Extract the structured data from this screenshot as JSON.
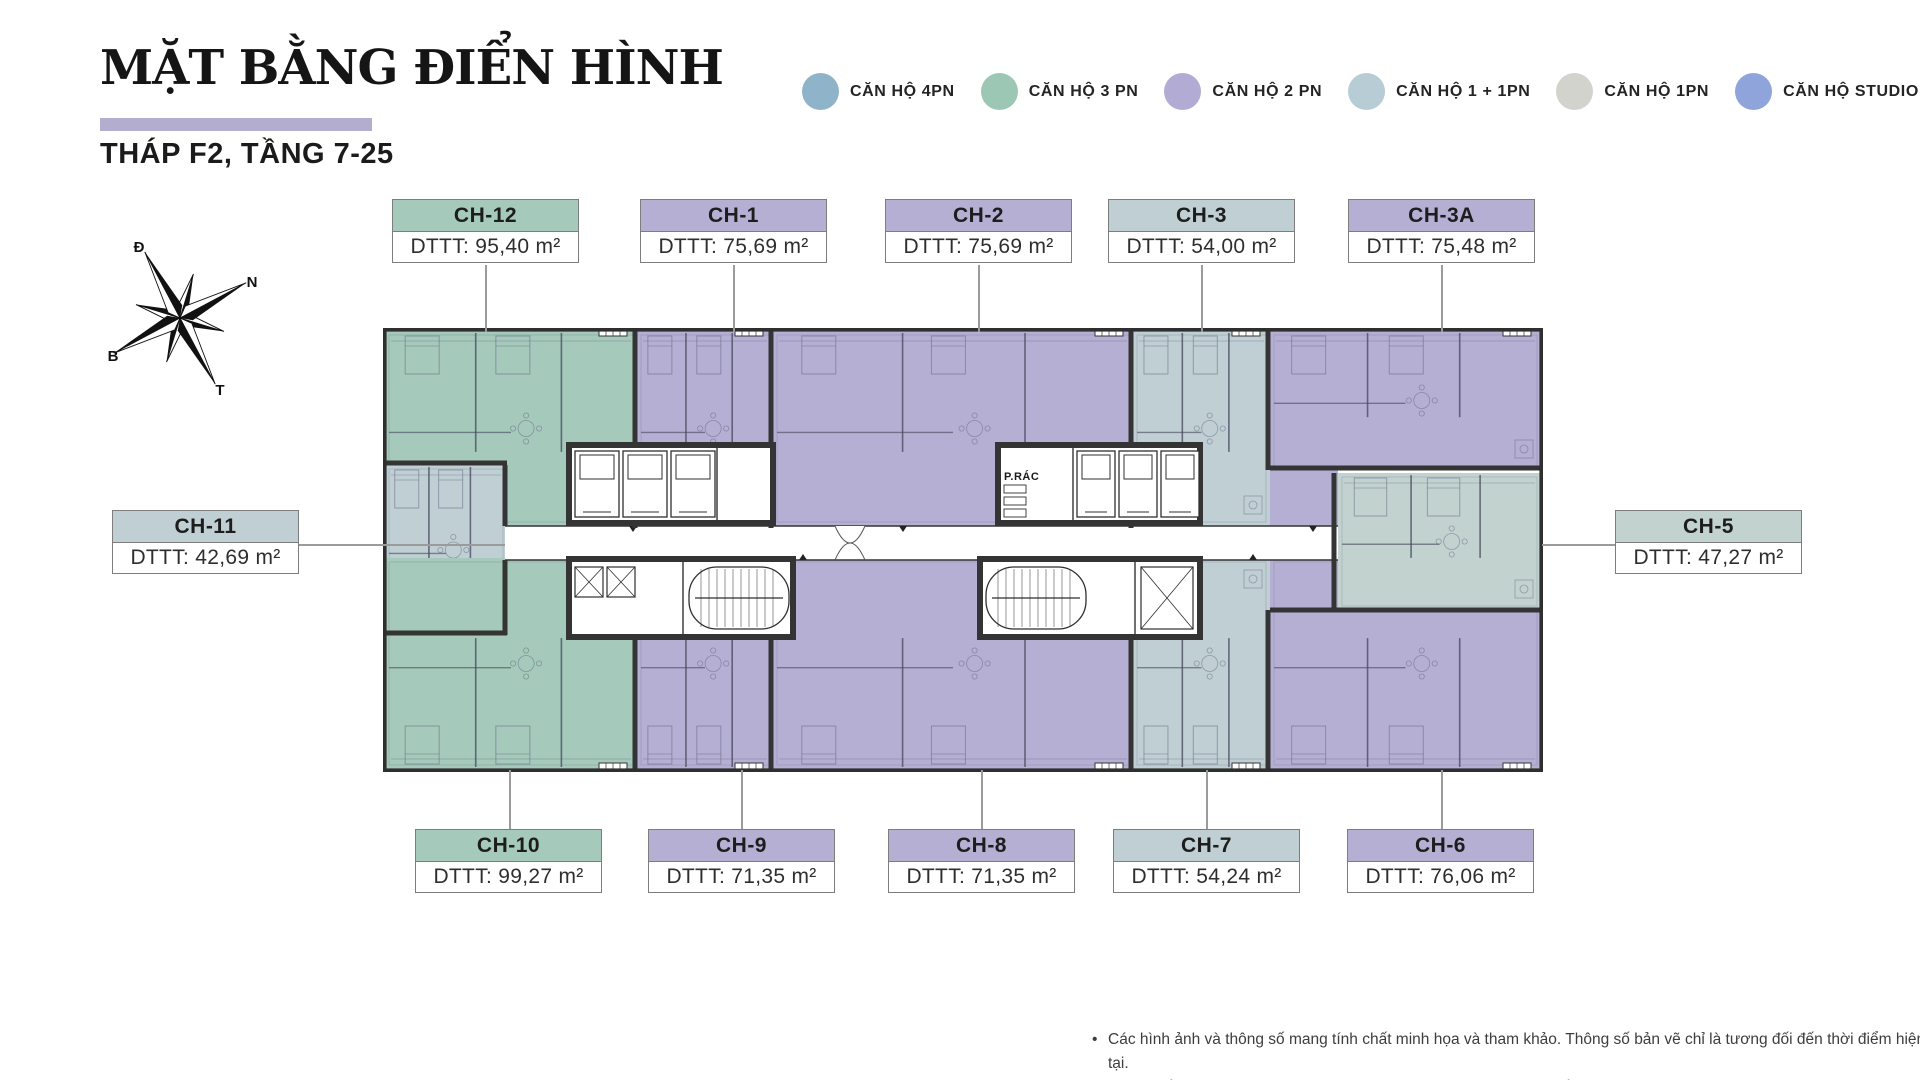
{
  "header": {
    "title": "MẶT BẰNG ĐIỂN HÌNH",
    "subtitle": "THÁP F2, TẦNG 7-25",
    "underline_color": "#b3aed0"
  },
  "legend": {
    "items": [
      {
        "label": "CĂN HỘ 4PN",
        "color": "#8fb4c9"
      },
      {
        "label": "CĂN HỘ 3 PN",
        "color": "#9cc7b4"
      },
      {
        "label": "CĂN HỘ 2 PN",
        "color": "#b2abd3"
      },
      {
        "label": "CĂN HỘ 1 + 1PN",
        "color": "#b7ccd4"
      },
      {
        "label": "CĂN HỘ 1PN",
        "color": "#d3d3cd"
      },
      {
        "label": "CĂN HỘ STUDIO",
        "color": "#8fa4da"
      }
    ]
  },
  "compass": {
    "labels": [
      {
        "text": "Đ",
        "x": 137,
        "y": 252
      },
      {
        "text": "N",
        "x": 250,
        "y": 287
      },
      {
        "text": "B",
        "x": 111,
        "y": 361
      },
      {
        "text": "T",
        "x": 218,
        "y": 395
      }
    ],
    "cx": 178,
    "cy": 318,
    "rotation": -28
  },
  "plan": {
    "x": 383,
    "y": 328,
    "w": 1160,
    "h": 444,
    "wall_color": "#343434",
    "line_color": "#60607d",
    "corridor": [
      122,
      198,
      833,
      34
    ],
    "trash_room_label": "P.RÁC",
    "type_colors": {
      "p3": "#a5c9ba",
      "p2": "#b5afd3",
      "p11": "#bfcfd4",
      "p11b": "#c2d3cf"
    },
    "units": [
      {
        "name": "CH-12",
        "area": "DTTT: 95,40 m²",
        "type": "p3",
        "rects": [
          [
            2,
            3,
            252,
            195
          ]
        ],
        "label": {
          "x": 392,
          "y": 199,
          "side": "top",
          "cx": 485
        }
      },
      {
        "name": "CH-1",
        "area": "DTTT: 75,69 m²",
        "type": "p2",
        "rects": [
          [
            254,
            3,
            136,
            195
          ]
        ],
        "label": {
          "x": 640,
          "y": 199,
          "side": "top",
          "cx": 733
        }
      },
      {
        "name": "CH-2",
        "area": "DTTT: 75,69 m²",
        "type": "p2",
        "rects": [
          [
            390,
            3,
            360,
            195
          ]
        ],
        "label": {
          "x": 885,
          "y": 199,
          "side": "top",
          "cx": 978
        }
      },
      {
        "name": "CH-3",
        "area": "DTTT: 54,00 m²",
        "type": "p11",
        "rects": [
          [
            750,
            3,
            137,
            195
          ]
        ],
        "label": {
          "x": 1108,
          "y": 199,
          "side": "top",
          "cx": 1201
        }
      },
      {
        "name": "CH-3A",
        "area": "DTTT: 75,48 m²",
        "type": "p2",
        "rects": [
          [
            887,
            3,
            271,
            139
          ],
          [
            887,
            142,
            68,
            88
          ]
        ],
        "label": {
          "x": 1348,
          "y": 199,
          "side": "top",
          "cx": 1441
        }
      },
      {
        "name": "CH-11",
        "area": "DTTT: 42,69 m²",
        "type": "p11",
        "rects": [
          [
            2,
            137,
            122,
            170
          ]
        ],
        "label": {
          "x": 112,
          "y": 510,
          "side": "left"
        }
      },
      {
        "name": "CH-10",
        "area": "DTTT: 99,27 m²",
        "type": "p3",
        "rects": [
          [
            2,
            230,
            252,
            211
          ]
        ],
        "label": {
          "x": 415,
          "y": 829,
          "side": "bottom",
          "cx": 509
        }
      },
      {
        "name": "CH-9",
        "area": "DTTT: 71,35 m²",
        "type": "p2",
        "rects": [
          [
            254,
            230,
            136,
            211
          ]
        ],
        "label": {
          "x": 648,
          "y": 829,
          "side": "bottom",
          "cx": 741
        }
      },
      {
        "name": "CH-8",
        "area": "DTTT: 71,35 m²",
        "type": "p2",
        "rects": [
          [
            390,
            230,
            360,
            211
          ]
        ],
        "label": {
          "x": 888,
          "y": 829,
          "side": "bottom",
          "cx": 981
        }
      },
      {
        "name": "CH-7",
        "area": "DTTT: 54,24 m²",
        "type": "p11",
        "rects": [
          [
            750,
            230,
            137,
            211
          ]
        ],
        "label": {
          "x": 1113,
          "y": 829,
          "side": "bottom",
          "cx": 1206
        }
      },
      {
        "name": "CH-6",
        "area": "DTTT: 76,06 m²",
        "type": "p2",
        "rects": [
          [
            887,
            230,
            271,
            211
          ]
        ],
        "label": {
          "x": 1347,
          "y": 829,
          "side": "bottom",
          "cx": 1441
        }
      },
      {
        "name": "CH-5",
        "area": "DTTT: 47,27 m²",
        "type": "p11b",
        "rects": [
          [
            955,
            145,
            203,
            137
          ]
        ],
        "label": {
          "x": 1615,
          "y": 510,
          "side": "right"
        }
      }
    ],
    "walls": {
      "verticals": [
        [
          252,
          0,
          200
        ],
        [
          388,
          0,
          200
        ],
        [
          748,
          0,
          200
        ],
        [
          885,
          0,
          142
        ],
        [
          252,
          230,
          212
        ],
        [
          388,
          230,
          212
        ],
        [
          748,
          230,
          212
        ],
        [
          885,
          282,
          160
        ],
        [
          951,
          145,
          137
        ],
        [
          122,
          137,
          61
        ],
        [
          122,
          232,
          75
        ]
      ],
      "horizontals": [
        [
          887,
          140,
          271
        ],
        [
          887,
          282,
          271
        ],
        [
          0,
          135,
          124
        ],
        [
          0,
          305,
          124
        ]
      ]
    },
    "cores": [
      {
        "x": 186,
        "y": 117,
        "w": 204,
        "h": 78,
        "div": [
          334
        ],
        "elev": [
          [
            192,
            123,
            44,
            66
          ],
          [
            240,
            123,
            44,
            66
          ],
          [
            288,
            123,
            44,
            66
          ]
        ],
        "xcells": [],
        "stair": null
      },
      {
        "x": 186,
        "y": 231,
        "w": 224,
        "h": 78,
        "div": [
          300
        ],
        "elev": [],
        "xcells": [
          [
            192,
            239,
            28,
            30
          ],
          [
            224,
            239,
            28,
            30
          ]
        ],
        "stair": [
          306,
          239,
          100,
          62
        ]
      },
      {
        "x": 615,
        "y": 117,
        "w": 202,
        "h": 78,
        "div": [
          690
        ],
        "elev": [
          [
            694,
            123,
            38,
            66
          ],
          [
            736,
            123,
            38,
            66
          ],
          [
            778,
            123,
            38,
            66
          ]
        ],
        "xcells": [],
        "stair": null,
        "trash": [
          621,
          152
        ]
      },
      {
        "x": 597,
        "y": 231,
        "w": 220,
        "h": 78,
        "div": [
          752
        ],
        "elev": [],
        "xcells": [
          [
            758,
            239,
            52,
            62
          ]
        ],
        "stair": [
          603,
          239,
          100,
          62
        ]
      }
    ],
    "door_marks": [
      [
        250,
        198
      ],
      [
        520,
        198
      ],
      [
        930,
        198
      ],
      [
        420,
        232
      ],
      [
        870,
        232
      ]
    ],
    "double_door": [
      452,
      198
    ]
  },
  "footer": {
    "bullet": "•",
    "lines": [
      "Các hình ảnh và thông số mang tính chất minh họa và tham khảo. Thông số bản vẽ chỉ là tương đối đến thời điểm hiện tại.",
      "Thông số chính thức của từng căn được quy định tại văn bản ký kết với Khách hàng/Theo quy định của CQNN"
    ]
  }
}
